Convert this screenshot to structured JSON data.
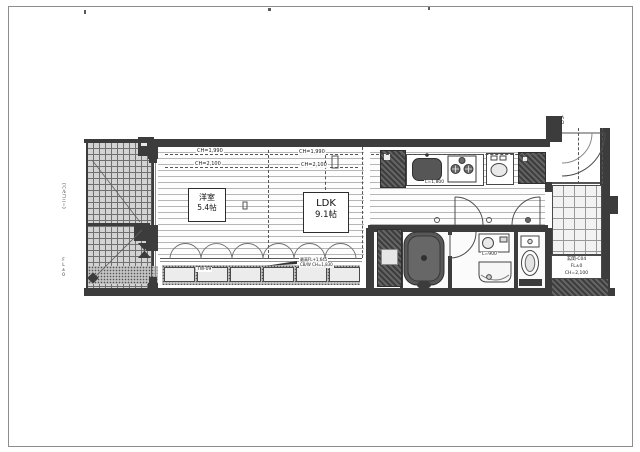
{
  "plan": {
    "rooms": {
      "western_room": {
        "name": "洋室",
        "size": "5.4帖"
      },
      "ldk": {
        "name": "LDK",
        "size": "9.1帖"
      }
    },
    "ceiling_heights": {
      "line1": "CH=1,990",
      "line2": "CH=2,100"
    },
    "kitchen": {
      "length": "L=1,800"
    },
    "washroom": {
      "vanity_length": "L=900"
    },
    "window_note": {
      "line1": "最高FL+1,645",
      "line2": "CB/W CH=1,830"
    },
    "sash_label": "TW-09",
    "entrance": {
      "line1": "玄関-C04",
      "line2": "FL±0",
      "line3": "CH=2,100",
      "door_label": "AD"
    },
    "balcony": {
      "note": "（バルコニー）",
      "fl": "FL±0"
    }
  },
  "colors": {
    "wall": "#3c3c3c",
    "line": "#555555",
    "accent": "#777777",
    "paper": "#ffffff"
  }
}
